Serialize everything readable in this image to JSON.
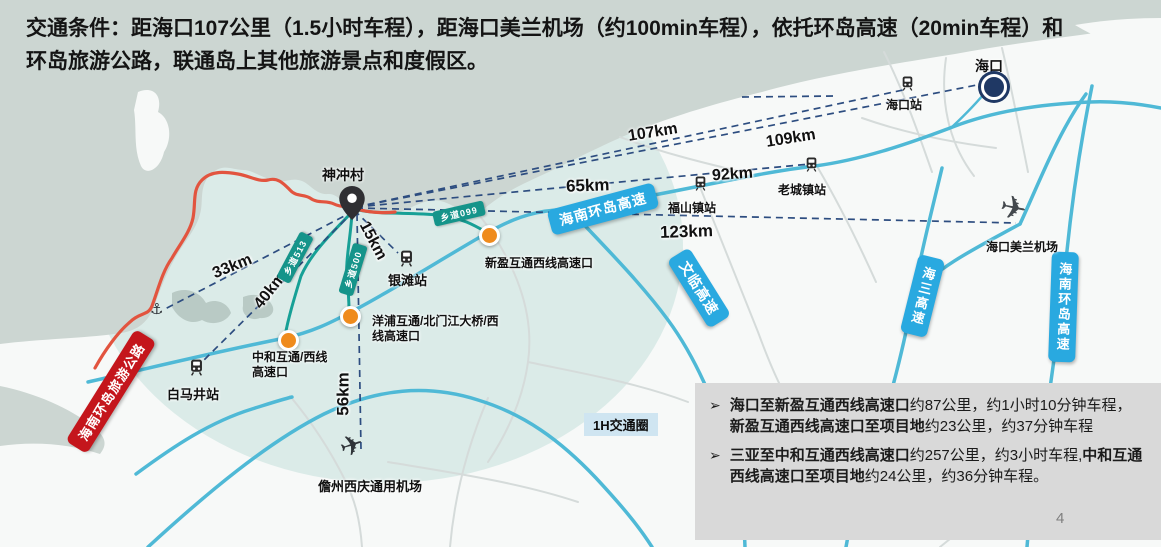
{
  "title": "交通条件：距海口107公里（1.5小时车程），距海口美兰机场（约100min车程），依托环岛高速（20min车程）和环岛旅游公路，联通岛上其他旅游景点和度假区。",
  "map": {
    "village": {
      "name": "神冲村"
    },
    "city": {
      "name": "海口"
    },
    "stations": [
      {
        "name": "海口站"
      },
      {
        "name": "老城镇站"
      },
      {
        "name": "福山镇站"
      },
      {
        "name": "银滩站"
      },
      {
        "name": "白马井站"
      }
    ],
    "airports": [
      {
        "name": "海口美兰机场"
      },
      {
        "name": "儋州西庆通用机场"
      }
    ],
    "interchanges": [
      {
        "name": "新盈互通西线高速口"
      },
      {
        "name": "中和互通/西线高速口"
      },
      {
        "name": "洋浦互通/北门江大桥/西线高速口"
      }
    ],
    "expressway_labels": [
      {
        "name": "海南环岛高速"
      },
      {
        "name": "文临高速"
      },
      {
        "name": "海三高速"
      },
      {
        "name": "海南环岛高速"
      }
    ],
    "county_roads": [
      {
        "name": "乡道099"
      },
      {
        "name": "乡道513"
      },
      {
        "name": "乡道500"
      }
    ],
    "scenic_road": {
      "name": "海南环岛旅游公路"
    },
    "distances": {
      "d107": "107km",
      "d109": "109km",
      "d92": "92km",
      "d65": "65km",
      "d123": "123km",
      "d33": "33km",
      "d40": "40km",
      "d15": "15km",
      "d56": "56km"
    },
    "circle_label": "1H交通圈",
    "anchor_icon_glyph": "⚓",
    "plane_icon_glyph": "✈"
  },
  "notes": {
    "marker": "➢",
    "items": [
      {
        "b1": "海口至新盈互通西线高速口",
        "t1": "约87公里，约1小时10分钟车程，",
        "b2": "新盈互通西线高速口至项目地",
        "t2": "约23公里，约37分钟车程"
      },
      {
        "b1": "三亚至中和互通西线高速口",
        "t1": "约257公里，约3小时车程,",
        "b2": "中和互通西线高速口至项目地",
        "t2": "约24公里，约36分钟车程。"
      }
    ]
  },
  "page_number": "4",
  "colors": {
    "sea": "#ccd6d2",
    "land": "#f7f9f8",
    "expressway_line": "#4fb9d6",
    "expressway_label_bg": "#29a9e0",
    "county_road_bg": "#15948a",
    "scenic_road_bg": "#c4161c",
    "scenic_road_line": "#e2543f",
    "interchange_dot": "#ef8b1d",
    "dashed_line": "#2d4d80",
    "hour_circle_fill": "rgba(167,208,203,0.35)",
    "notes_bg": "#d9d9d9"
  }
}
